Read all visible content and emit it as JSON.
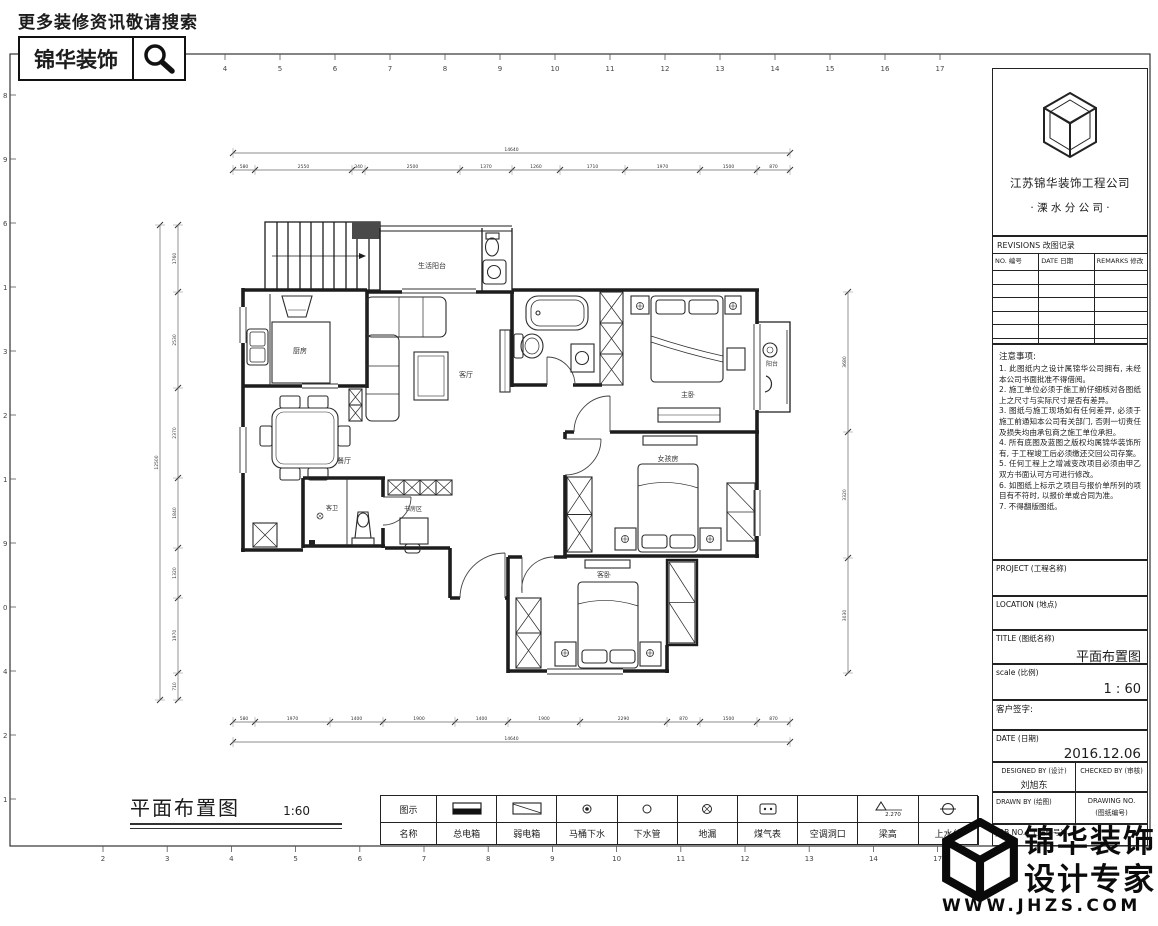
{
  "promo": {
    "hint": "更多装修资讯敬请搜索",
    "brand": "锦华装饰"
  },
  "sheet": {
    "ruler_top": [
      "1",
      "2",
      "3",
      "4",
      "5",
      "6",
      "7",
      "8",
      "9",
      "10",
      "11",
      "12",
      "13",
      "14",
      "15",
      "16",
      "17"
    ],
    "ruler_bottom": [
      "2",
      "3",
      "4",
      "5",
      "6",
      "7",
      "8",
      "9",
      "10",
      "11",
      "12",
      "13",
      "14",
      "17"
    ],
    "ruler_left": [
      "8",
      "9",
      "6",
      "1",
      "3",
      "2",
      "1",
      "9",
      "0",
      "4",
      "2",
      "1"
    ]
  },
  "plan": {
    "title": "平面布置图",
    "scale": "1:60",
    "rooms": [
      {
        "name": "生活阳台",
        "x": 432,
        "y": 268,
        "s": 7
      },
      {
        "name": "厨房",
        "x": 300,
        "y": 353,
        "s": 7
      },
      {
        "name": "客厅",
        "x": 466,
        "y": 377,
        "s": 7
      },
      {
        "name": "餐厅",
        "x": 344,
        "y": 463,
        "s": 7
      },
      {
        "name": "主卧",
        "x": 688,
        "y": 397,
        "s": 7
      },
      {
        "name": "女孩房",
        "x": 668,
        "y": 461,
        "s": 7
      },
      {
        "name": "客卧",
        "x": 604,
        "y": 577,
        "s": 7
      },
      {
        "name": "客卫",
        "x": 332,
        "y": 510,
        "s": 6
      },
      {
        "name": "书房区",
        "x": 413,
        "y": 511,
        "s": 6
      },
      {
        "name": "阳台",
        "x": 772,
        "y": 366,
        "s": 6
      }
    ],
    "dimensions": {
      "top_total": "14640",
      "top": [
        "580",
        "2550",
        "340",
        "2500",
        "1370",
        "1260",
        "1710",
        "1970",
        "1500",
        "870"
      ],
      "bottom": [
        "580",
        "1970",
        "1400",
        "1900",
        "1400",
        "1900",
        "2290",
        "870",
        "1500",
        "870"
      ],
      "bottom_total": "14640",
      "left": [
        "1760",
        "2530",
        "2370",
        "1840",
        "1320",
        "1970",
        "710"
      ],
      "left_total": "12500",
      "right": [
        "3680",
        "3320",
        "3030"
      ]
    }
  },
  "legend": {
    "col1_row1": "图示",
    "col1_row2": "名称",
    "items": [
      {
        "name": "总电箱",
        "symbol": "main-panel"
      },
      {
        "name": "弱电箱",
        "symbol": "weak-panel"
      },
      {
        "name": "马桶下水",
        "symbol": "toilet-drain"
      },
      {
        "name": "下水管",
        "symbol": "drain-pipe"
      },
      {
        "name": "地漏",
        "symbol": "floor-drain"
      },
      {
        "name": "煤气表",
        "symbol": "gas-meter"
      },
      {
        "name": "空调洞口",
        "symbol": "ac-hole"
      },
      {
        "name": "梁高",
        "symbol": "beam-height",
        "value": "2.270"
      },
      {
        "name": "上水位",
        "symbol": "water-level"
      }
    ]
  },
  "title_block": {
    "company": "江苏锦华装饰工程公司",
    "branch": "· 溧 水 分 公 司 ·",
    "revisions": {
      "title": "REVISIONS 改图记录",
      "columns": [
        "NO. 编号",
        "DATE 日期",
        "REMARKS 修改"
      ],
      "empty_rows": 6
    },
    "notes_title": "注意事项:",
    "notes": [
      "1. 此图纸内之设计属锦华公司拥有, 未经本公司书面批准不得借阅。",
      "2. 施工单位必须于施工前仔细核对各图纸上之尺寸与实际尺寸是否有差异。",
      "3. 图纸与施工现场如有任何差异, 必须于施工前通知本公司有关部门, 否则一切责任及损失均由承包商之施工单位承担。",
      "4. 所有底图及蓝图之版权均属锦华装饰所有, 于工程竣工后必须缴还交回公司存案。",
      "5. 任何工程上之增减变改项目必须由甲乙双方书面认可方可进行修改。",
      "6. 如图纸上标示之项目与报价单所列的项目有不符时, 以报价单或合同为准。",
      "7. 不得翻版图纸。"
    ],
    "project_label": "PROJECT (工程名称)",
    "location_label": "LOCATION (地点)",
    "title_label": "TITLE (图纸名称)",
    "title_value": "平面布置图",
    "scale_label": "scale (比例)",
    "scale_value": "1  :  60",
    "client_sign_label": "客户签字:",
    "date_label": "DATE (日期)",
    "date_value": "2016.12.06",
    "designed_by_label": "DESIGNED BY (设计)",
    "designed_by_value": "刘旭东",
    "checked_by_label": "CHECKED BY (审核)",
    "drawn_by_label": "DRAWN BY (绘图)",
    "drawing_no_label": "DRAWING NO.",
    "drawing_no_sub": "(图纸编号)",
    "job_no_label": "JOB NO. (工程编号)"
  },
  "footer_brand": {
    "name": "锦华装饰",
    "tagline": "设计专家",
    "site": "WWW.JHZS.COM"
  }
}
